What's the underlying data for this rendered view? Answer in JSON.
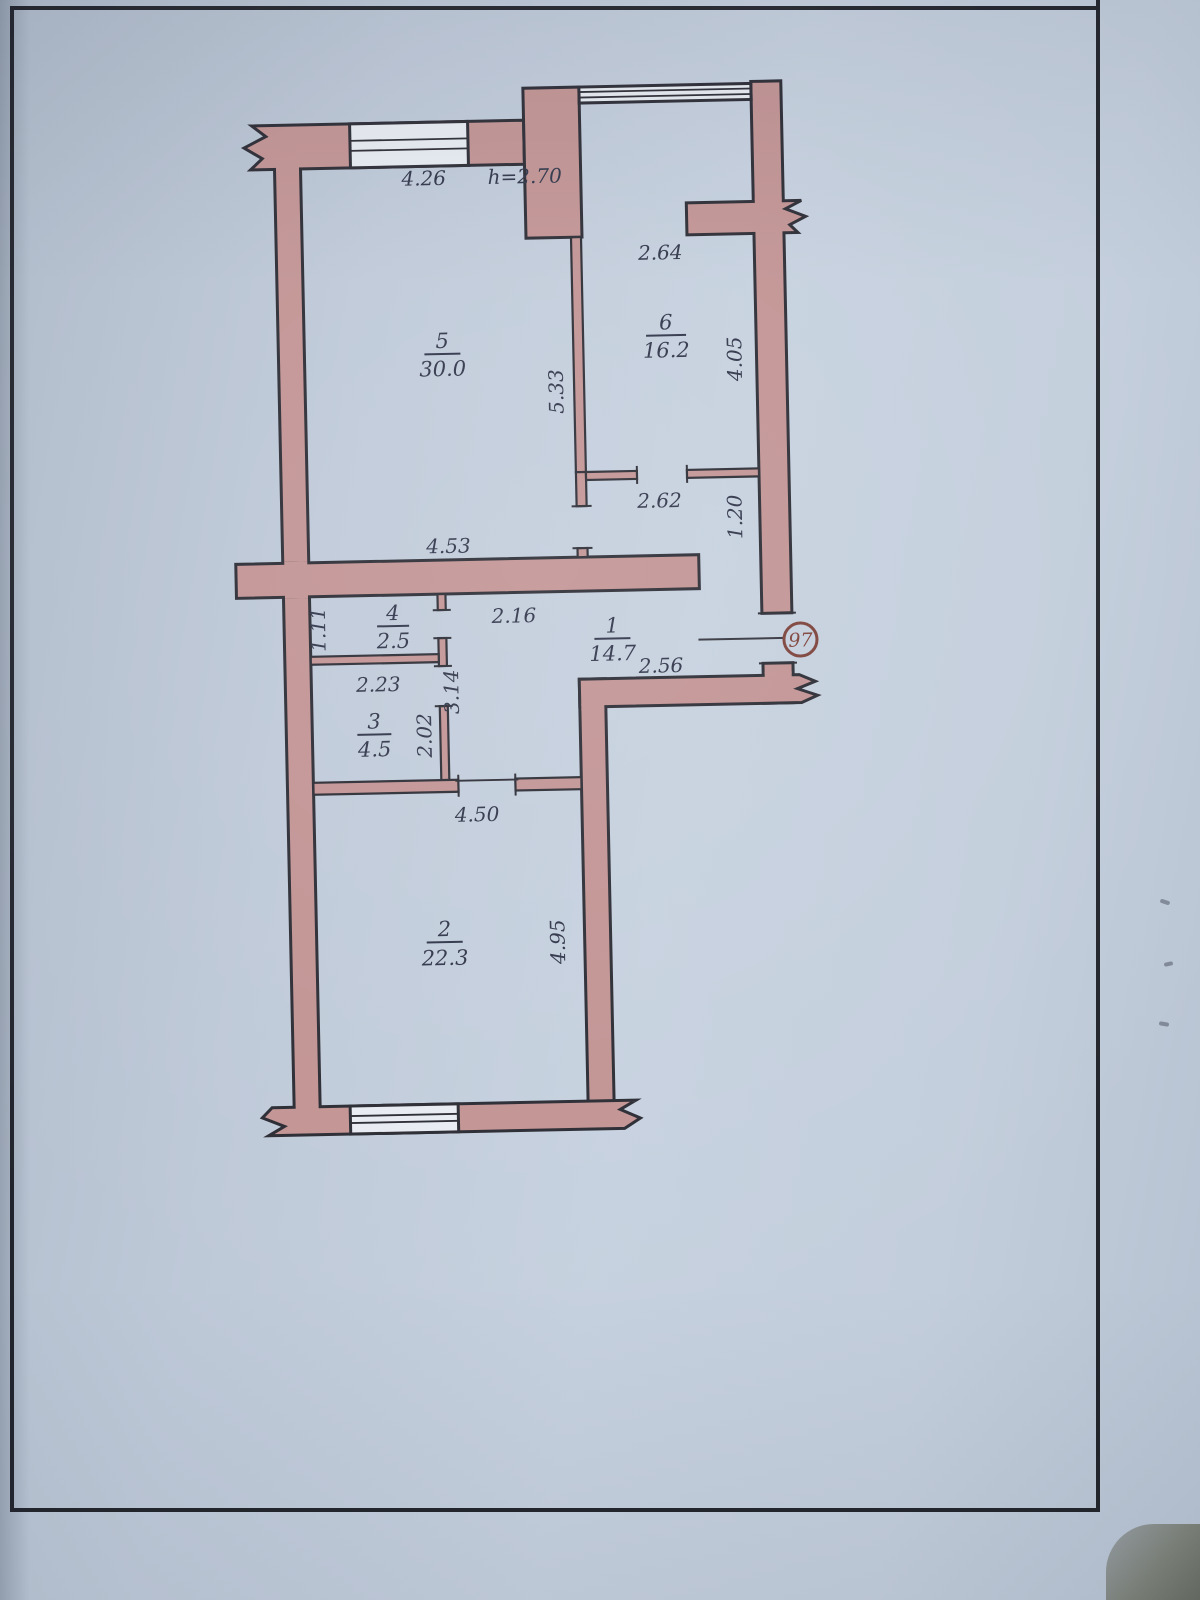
{
  "plan": {
    "badge_number": "97",
    "ceiling_height": "h=2.70",
    "rooms": [
      {
        "number": "1",
        "area": "14.7"
      },
      {
        "number": "2",
        "area": "22.3"
      },
      {
        "number": "3",
        "area": "4.5"
      },
      {
        "number": "4",
        "area": "2.5"
      },
      {
        "number": "5",
        "area": "30.0"
      },
      {
        "number": "6",
        "area": "16.2"
      }
    ],
    "dims": {
      "room5_width": "4.26",
      "loggia_width": "2.64",
      "room5_depth": "5.33",
      "room6_depth": "4.05",
      "vestibule_width": "2.62",
      "vestibule_depth": "1.20",
      "mid_wall": "4.53",
      "corridor_width": "2.16",
      "room4_depth": "1.11",
      "room3_width": "2.23",
      "corridor_depth": "3.14",
      "room3_depth": "2.02",
      "hall_width": "2.56",
      "room2_width": "4.50",
      "room2_depth": "4.95"
    },
    "colors": {
      "wall": "#c29393",
      "outline": "#2a2a33",
      "ink": "#2d3347",
      "badge": "#7b4038",
      "paper": "#c2cddb",
      "window": "#e8ecf2"
    }
  }
}
